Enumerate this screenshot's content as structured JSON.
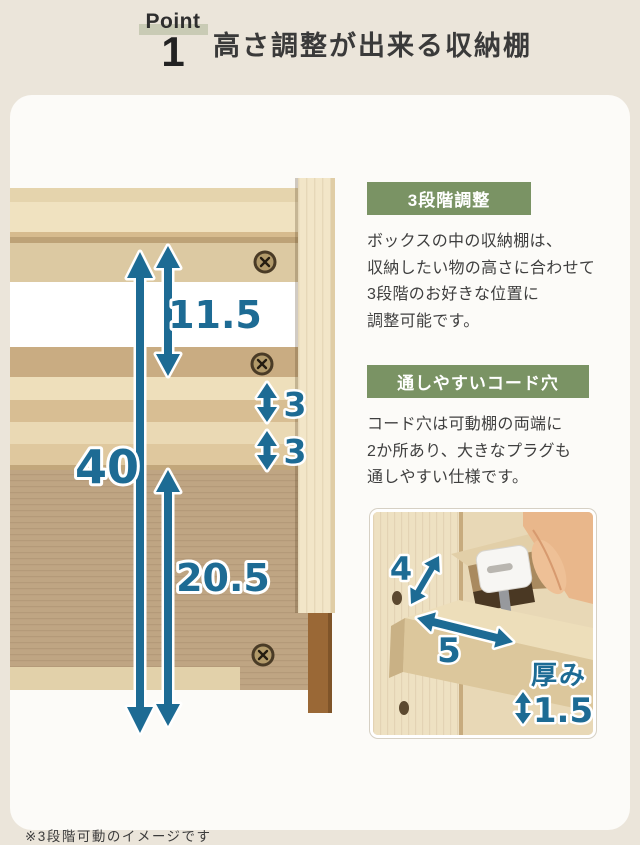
{
  "header": {
    "point_label": "Point",
    "point_number": "1",
    "title": "高さ調整が出来る収納棚"
  },
  "colors": {
    "accent_teal": "#1d6b94",
    "label_green": "#7a9364",
    "point_highlight": "#c9cbb5",
    "background": "#ebe5da",
    "card": "#fcfbf8"
  },
  "diagram": {
    "note": "※3段階可動のイメージです",
    "measurements": {
      "total_height": "40",
      "upper_space": "11.5",
      "pitch_top": "3",
      "pitch_bottom": "3",
      "lower_space": "20.5"
    }
  },
  "sections": [
    {
      "label": "3段階調整",
      "lines": [
        "ボックスの中の収納棚は、",
        "収納したい物の高さに合わせて",
        "3段階のお好きな位置に",
        "調整可能です。"
      ]
    },
    {
      "label": "通しやすいコード穴",
      "lines": [
        "コード穴は可動棚の両端に",
        "2か所あり、大きなプラグも",
        "通しやすい仕様です。"
      ]
    }
  ],
  "inset": {
    "hole_height": "4",
    "hole_width": "5",
    "thickness_label": "厚み",
    "thickness_value": "1.5"
  }
}
